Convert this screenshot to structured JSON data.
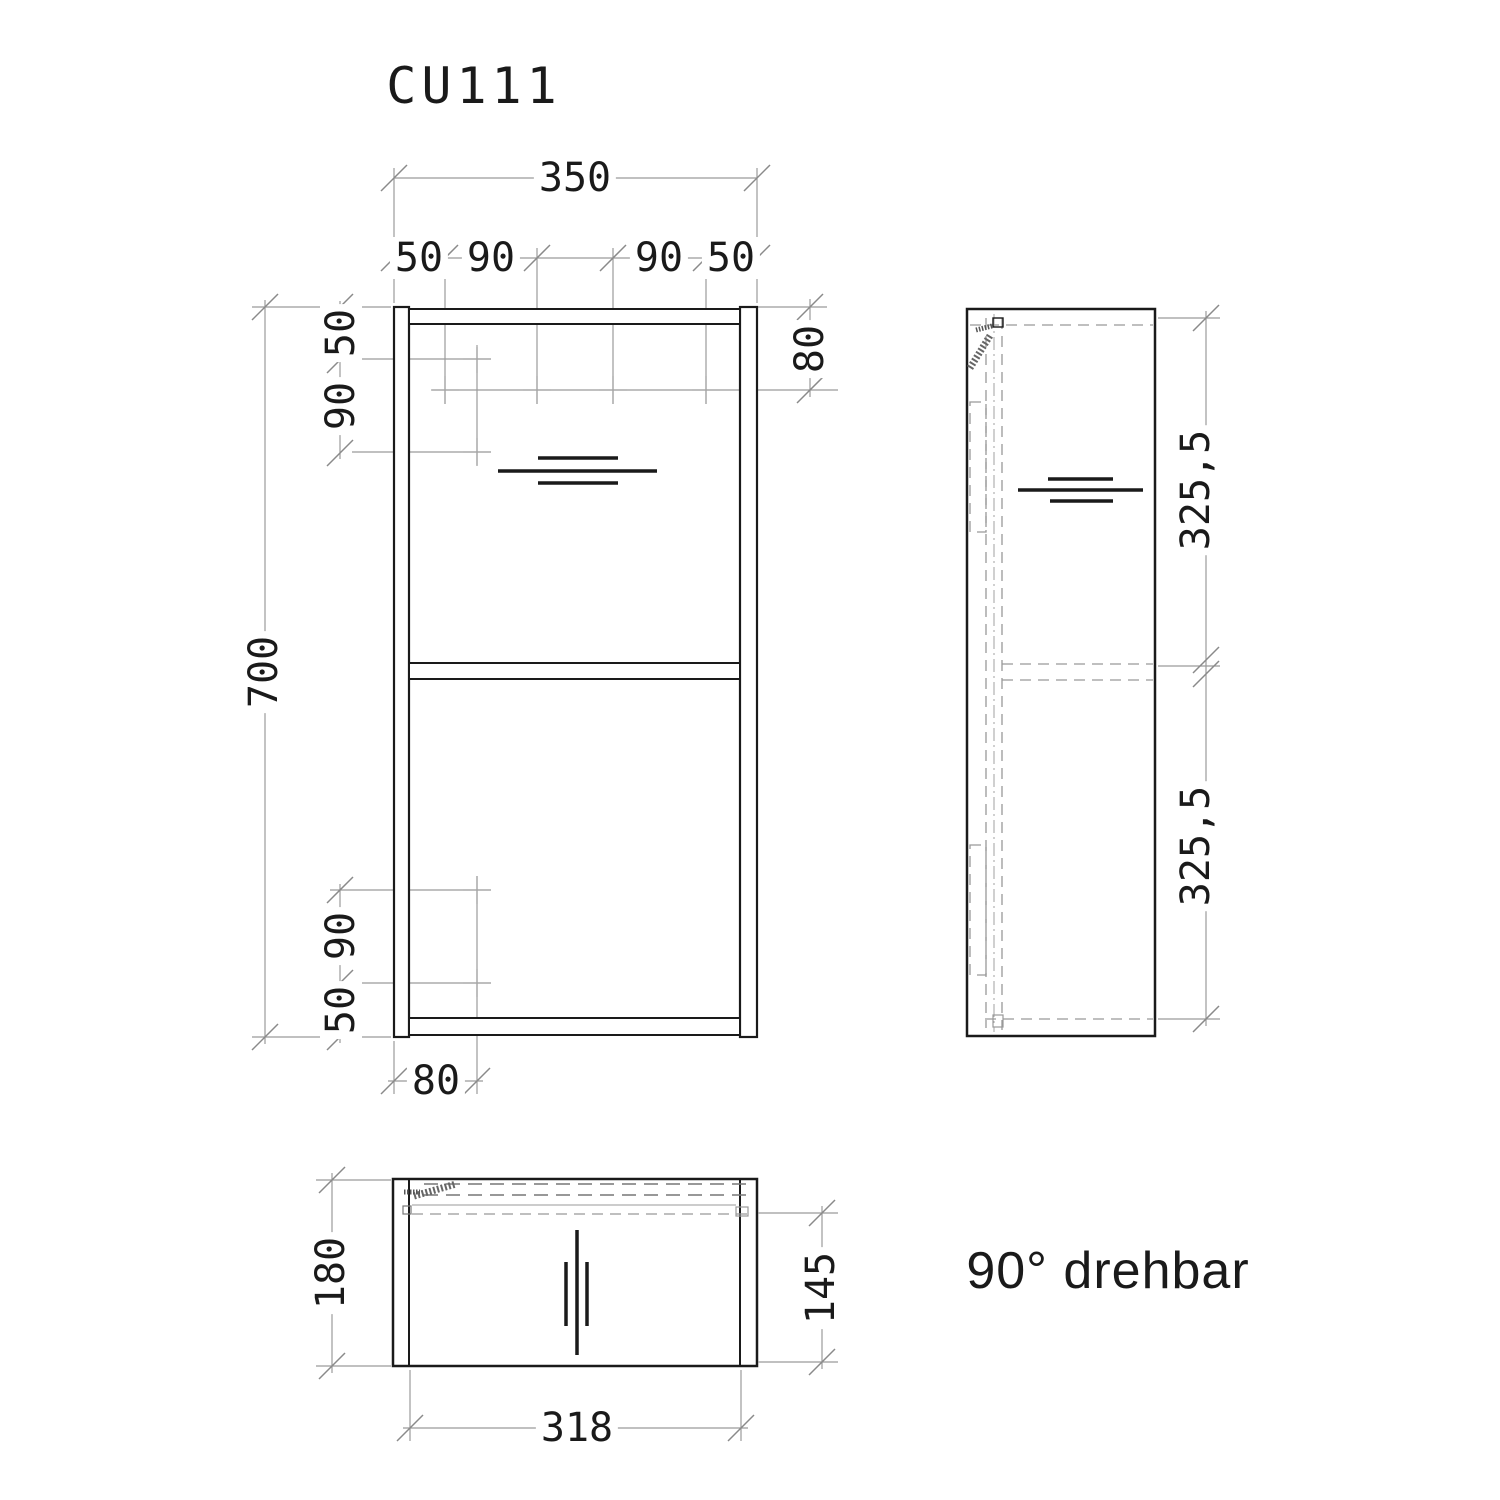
{
  "title": "CU111",
  "note": "90° drehbar",
  "colors": {
    "ink": "#1a1a1a",
    "dim_line": "#9b9b9b",
    "background": "#ffffff"
  },
  "front": {
    "width_total": "350",
    "width_segments": [
      "50",
      "90",
      "90",
      "50"
    ],
    "height_total": "700",
    "left_top_segments": [
      "50",
      "90"
    ],
    "left_bottom_segments": [
      "90",
      "50"
    ],
    "offset_top_right": "80",
    "offset_bottom_left": "80"
  },
  "side": {
    "height_upper": "325,5",
    "height_lower": "325,5"
  },
  "top": {
    "depth_total": "180",
    "depth_inner": "145",
    "width_inner": "318"
  }
}
